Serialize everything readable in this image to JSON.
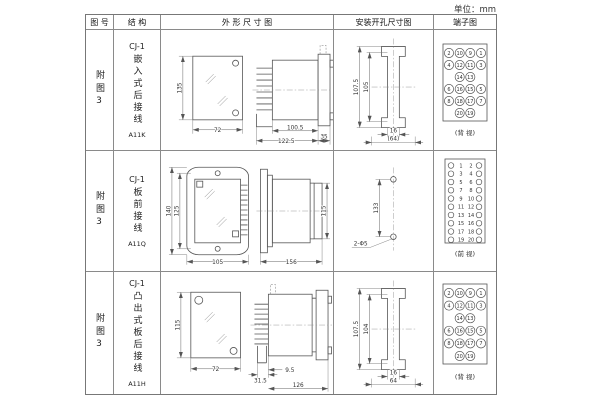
{
  "unit_label": "单位：mm",
  "header": {
    "col_fig": "图 号",
    "col_structure": "结 构",
    "col_outline": "外 形 尺 寸 图",
    "col_install": "安装开孔尺寸图",
    "col_terminal": "端子图"
  },
  "rows": [
    {
      "fig_no": "附图3",
      "series": "CJ-1",
      "structure": "嵌入式后接线",
      "model": "A11K",
      "outline_dims": {
        "front_height": "135",
        "front_width": "72",
        "body_depth": "100.5",
        "total_depth": "122.5",
        "flange_depth": "35"
      },
      "install_dims": {
        "outer_height": "107.5",
        "inner_height": "105",
        "slot_width": "16",
        "overall_width": "(64)"
      },
      "terminal": {
        "caption": "(背 视)",
        "style": "rear",
        "rows": [
          [
            "2",
            "10",
            "9",
            "1"
          ],
          [
            "4",
            "12",
            "11",
            "3"
          ],
          [
            "",
            "14",
            "13",
            ""
          ],
          [
            "6",
            "16",
            "15",
            "5"
          ],
          [
            "8",
            "18",
            "17",
            "7"
          ],
          [
            "",
            "20",
            "19",
            ""
          ]
        ]
      }
    },
    {
      "fig_no": "附图3",
      "series": "CJ-1",
      "structure": "板前接线",
      "model": "A11Q",
      "outline_dims": {
        "front_outer_height": "140",
        "front_inner_height": "125",
        "front_width": "105",
        "side_length": "156",
        "side_height": "115"
      },
      "install_dims": {
        "hole_spacing": "133",
        "hole_label": "2-Φ5"
      },
      "terminal": {
        "caption": "(前 视)",
        "style": "front",
        "rows": [
          [
            "1",
            "2"
          ],
          [
            "3",
            "4"
          ],
          [
            "5",
            "6"
          ],
          [
            "7",
            "8"
          ],
          [
            "9",
            "10"
          ],
          [
            "11",
            "12"
          ],
          [
            "13",
            "14"
          ],
          [
            "15",
            "16"
          ],
          [
            "17",
            "18"
          ],
          [
            "19",
            "20"
          ]
        ]
      }
    },
    {
      "fig_no": "附图3",
      "series": "CJ-1",
      "structure": "凸出式板后接线",
      "model": "A11H",
      "outline_dims": {
        "front_height": "115",
        "front_width": "72",
        "pin_depth": "31.5",
        "step_depth": "9.5",
        "body_depth": "126"
      },
      "install_dims": {
        "outer_height": "107.5",
        "inner_height": "104",
        "slot_width": "16",
        "overall_width": "64"
      },
      "terminal": {
        "caption": "(背 视)",
        "style": "rear",
        "rows": [
          [
            "2",
            "10",
            "9",
            "1"
          ],
          [
            "4",
            "12",
            "11",
            "3"
          ],
          [
            "",
            "14",
            "13",
            ""
          ],
          [
            "6",
            "16",
            "15",
            "5"
          ],
          [
            "8",
            "18",
            "17",
            "7"
          ],
          [
            "",
            "20",
            "19",
            ""
          ]
        ]
      }
    }
  ]
}
